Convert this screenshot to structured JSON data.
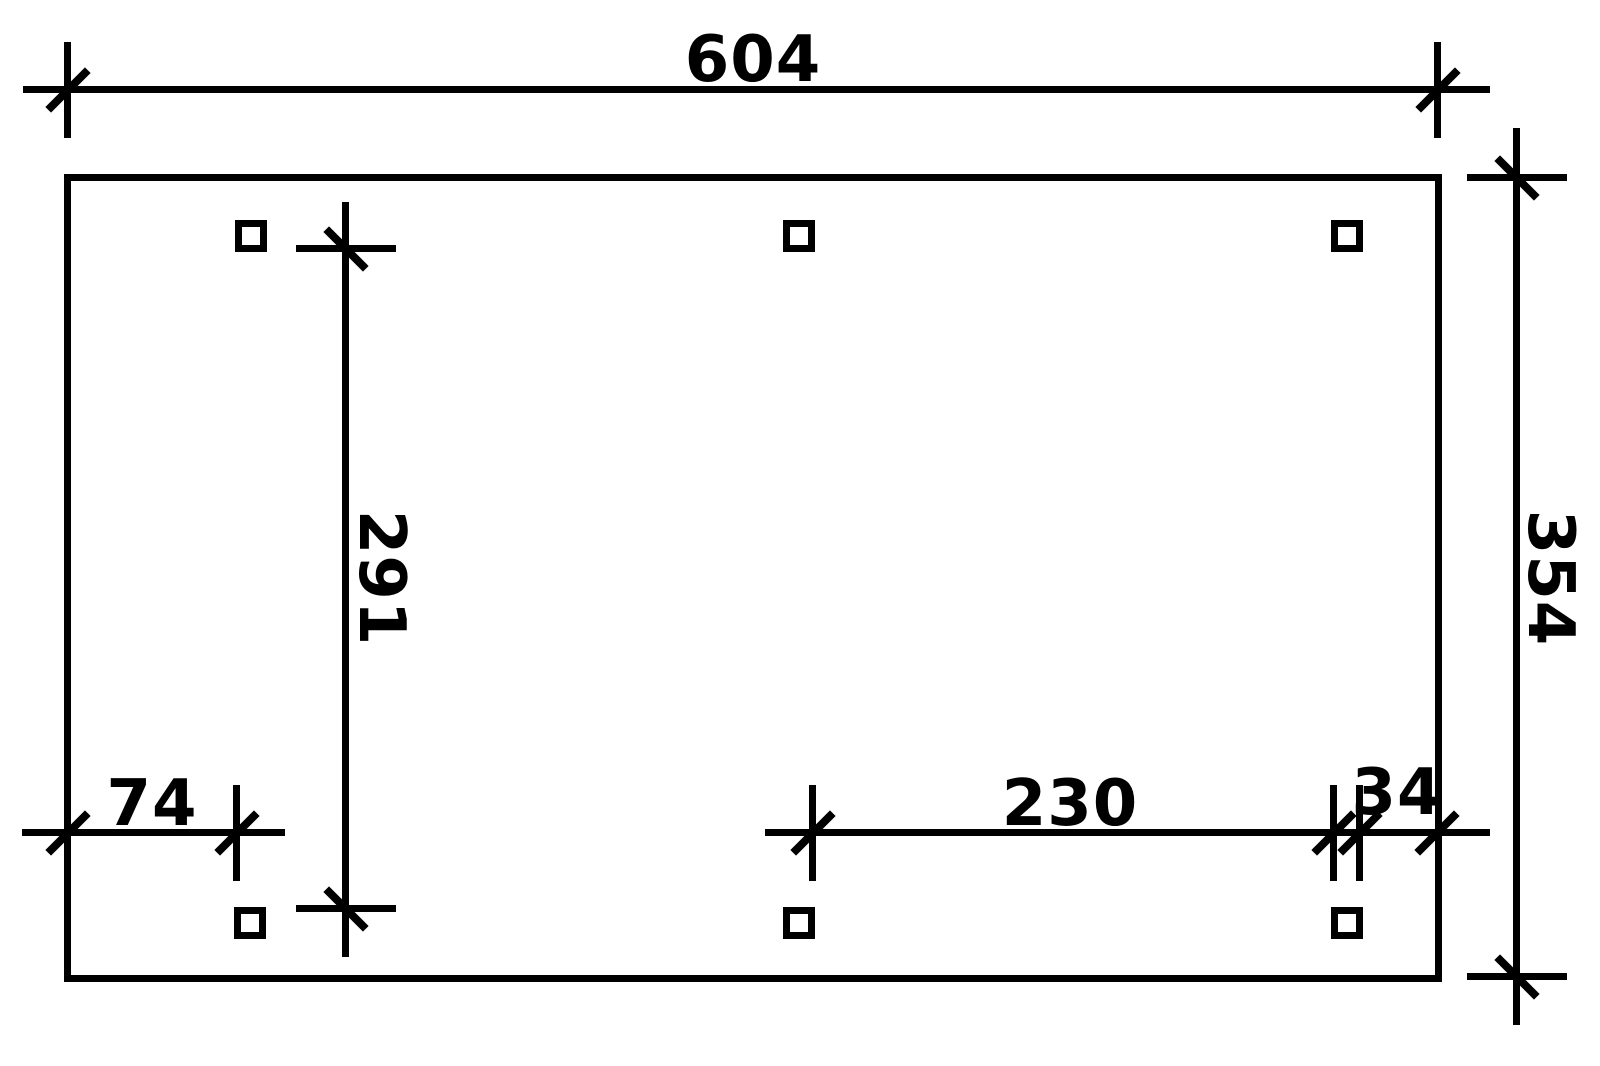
{
  "drawing": {
    "type": "carport-floor-plan",
    "dimensions": {
      "total_width": "604",
      "total_depth": "354",
      "clear_depth": "291",
      "left_offset": "74",
      "post_spacing": "230",
      "right_offset": "34"
    },
    "posts": {
      "count": 6,
      "marker": "square"
    },
    "colors": {
      "line": "#000000",
      "background": "#ffffff"
    }
  }
}
